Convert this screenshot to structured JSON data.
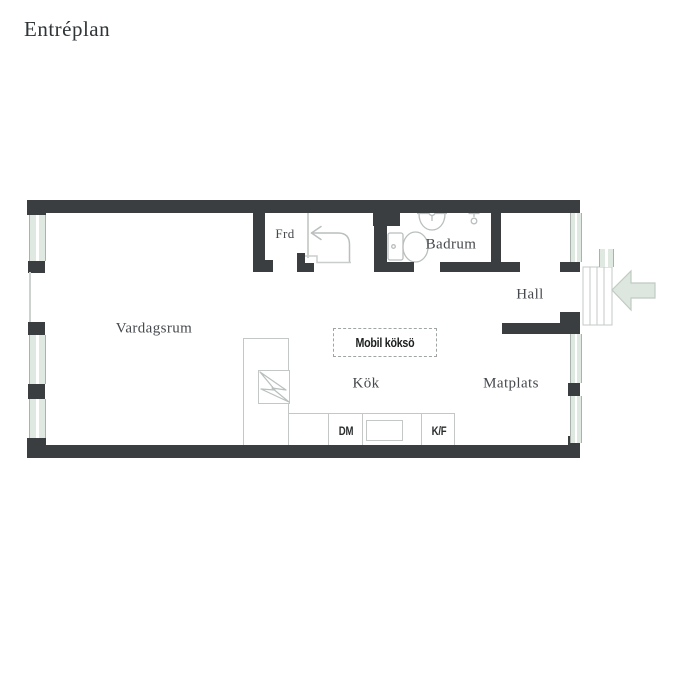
{
  "title": "Entréplan",
  "rooms": {
    "vardagsrum": "Vardagsrum",
    "frd": "Frd",
    "badrum": "Badrum",
    "hall": "Hall",
    "kok": "Kök",
    "matplats": "Matplats"
  },
  "annotations": {
    "mobile_island": "Mobil köksö",
    "dishwasher": "DM",
    "fridge_freezer": "K/F"
  },
  "icons": {
    "toilet": "toilet-icon",
    "sink": "sink-icon",
    "tap": "tap-icon",
    "stove": "stove-icon",
    "entry_direction": "entry-direction-arrow-icon",
    "entrance_arrow": "entrance-arrow-icon",
    "entry_steps": "entry-steps"
  },
  "colors": {
    "wall": "#3a3e40",
    "window-fill": "#dfe8e1",
    "window-edge": "#a9b3ac",
    "arrow-fill": "#dde7df",
    "arrow-edge": "#bfcbc2",
    "fixture": "#b9bebe",
    "counter": "#c3c8c6",
    "text": "#45494d",
    "island-text": "#1d1f20"
  }
}
